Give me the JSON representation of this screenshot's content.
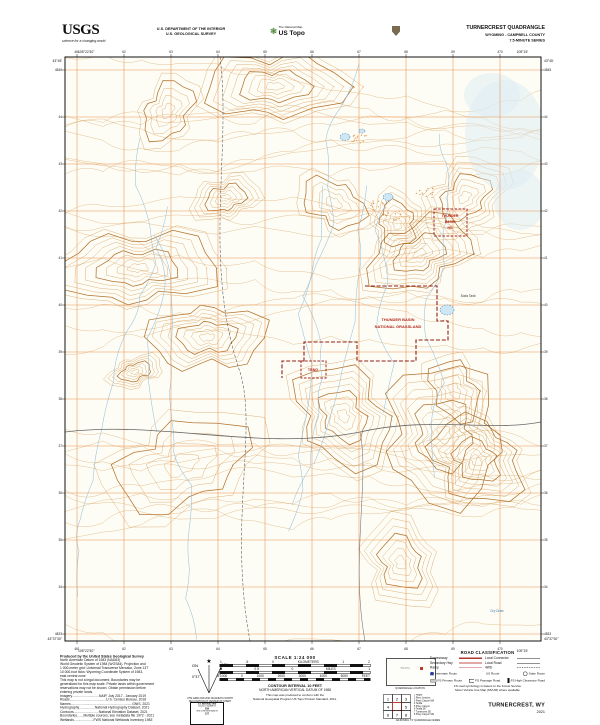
{
  "header": {
    "usgs_logo": "USGS",
    "usgs_tagline": "science for a changing world",
    "dept_line1": "U.S. DEPARTMENT OF THE INTERIOR",
    "dept_line2": "U.S. GEOLOGICAL SURVEY",
    "ustopo_small": "The National Map",
    "ustopo_big": "US Topo",
    "quad_title": "TURNERCREST QUADRANGLE",
    "quad_subtitle1": "WYOMING - CAMPBELL COUNTY",
    "quad_subtitle2": "7.5-MINUTE SERIES"
  },
  "map": {
    "labels": {
      "ng_box": [
        "THUNDER",
        "BASIN",
        "NG"
      ],
      "grassland": [
        "THUNDER BASIN",
        "NATIONAL GRASSLAND"
      ],
      "tbng": "TBNG",
      "soda_tank": "Soda Tank",
      "dry_draw": "Dry Draw"
    },
    "collar": {
      "nw_lat": "43°45'",
      "nw_lon": "105°22'30\"",
      "ne_lat": "43°45'",
      "ne_lon": "105°15'",
      "sw_lat": "43°37'30\"",
      "sw_lon": "105°22'30\"",
      "se_lat": "43°37'30\"",
      "se_lon": "105°15'",
      "top_ticks": [
        "461",
        "62",
        "63",
        "64",
        "65",
        "66",
        "67",
        "68",
        "69",
        "470"
      ],
      "left_ticks": [
        "4845",
        "44",
        "43",
        "42",
        "41",
        "40",
        "39",
        "38",
        "37",
        "36",
        "35",
        "34",
        "4833"
      ]
    }
  },
  "footer": {
    "credits": {
      "title": "Produced by the United States Geological Survey",
      "lines": [
        "North American Datum of 1983 (NAD83)",
        "World Geodetic System of 1984 (WGS84).  Projection and",
        "1 000-meter grid: Universal Transverse Mercator, Zone 13T",
        "10 000-foot ticks: Wyoming Coordinate System of 1983,",
        "east central zone",
        "This map is not a legal document. Boundaries may be",
        "generalized for this map scale. Private lands within government",
        "reservations may not be shown. Obtain permission before",
        "entering private lands.",
        "Imagery.............................NAIP, July 2017 - January 2019",
        "Roads.......................................U.S. Census Bureau, 2018",
        "Names..................................................................GNIS, 2021",
        "Hydrography.................National Hydrography Dataset, 2021",
        "Contours...........................National Elevation Dataset, 2021",
        "Boundaries.......Multiple sources; see metadata file 1972 - 2021",
        "Wetlands.....................FWS National Wetlands Inventory 1983"
      ]
    },
    "declination": {
      "star": "★",
      "gn": "GN",
      "mn": "MN",
      "gn_val": "0°37'",
      "mn_val": "8°",
      "cap1": "UTM GRID AND 2021 MAGNETIC NORTH",
      "cap2": "DECLINATION AT CENTER OF SHEET"
    },
    "usng": {
      "l1": "U.S. NATIONAL GRID",
      "l2": "100,000-m SQUARE ID",
      "square_id": "GH",
      "l3": "GRID ZONE DESIGNATION",
      "zone": "13T"
    },
    "scale": {
      "title": "SCALE 1:24 000",
      "km": [
        "1",
        ".5",
        "0",
        "KILOMETERS",
        "1",
        "2"
      ],
      "mi": [
        "1",
        "0.5",
        "0",
        "MILES",
        "1"
      ],
      "ft": [
        "1000",
        "0",
        "1000",
        "2000",
        "3000",
        "4000",
        "5000",
        "FEET"
      ],
      "contour": "CONTOUR INTERVAL 10 FEET",
      "datum": "NORTH AMERICAN VERTICAL DATUM OF 1988",
      "note1": "This map was produced to conform with the",
      "note2": "National Geospatial Program US Topo Product Standard, 2011."
    },
    "locator": {
      "state": "Wyoming",
      "caption": "QUADRANGLE LOCATION"
    },
    "adjoining": {
      "caption": "ADJOINING 7.5' QUADRANGLE NAMES",
      "grid_numbers": [
        "1",
        "2",
        "3",
        "4",
        "5",
        "6",
        "7",
        "8"
      ],
      "names": [
        "1  Hilight",
        "2  Reno Junction",
        "3  Piney Canyon NW",
        "4  Teckla",
        "5  Piney Canyon",
        "6  Teckla SE",
        "7  Turnercrest SE",
        "8  Piney Canyon SW"
      ]
    },
    "roads": {
      "title": "ROAD CLASSIFICATION",
      "expressway": "Expressway",
      "secondary": "Secondary Hwy",
      "ramp": "Ramp",
      "local_connector": "Local Connector",
      "local_road": "Local Road",
      "fwd": "4WD",
      "interstate": "Interstate Route",
      "us_route": "US Route",
      "state_route": "State Route",
      "fs_primary": "FS Primary Route",
      "fs_passage": "FS Passage Road",
      "fs_high": "FS High Clearance Road",
      "note1": "FS road symbology is based on the Forest Service",
      "note2": "Motor Vehicle Use Map (MVUM) where available"
    },
    "title_block": {
      "name": "TURNERCREST, WY",
      "year": "2021"
    }
  }
}
